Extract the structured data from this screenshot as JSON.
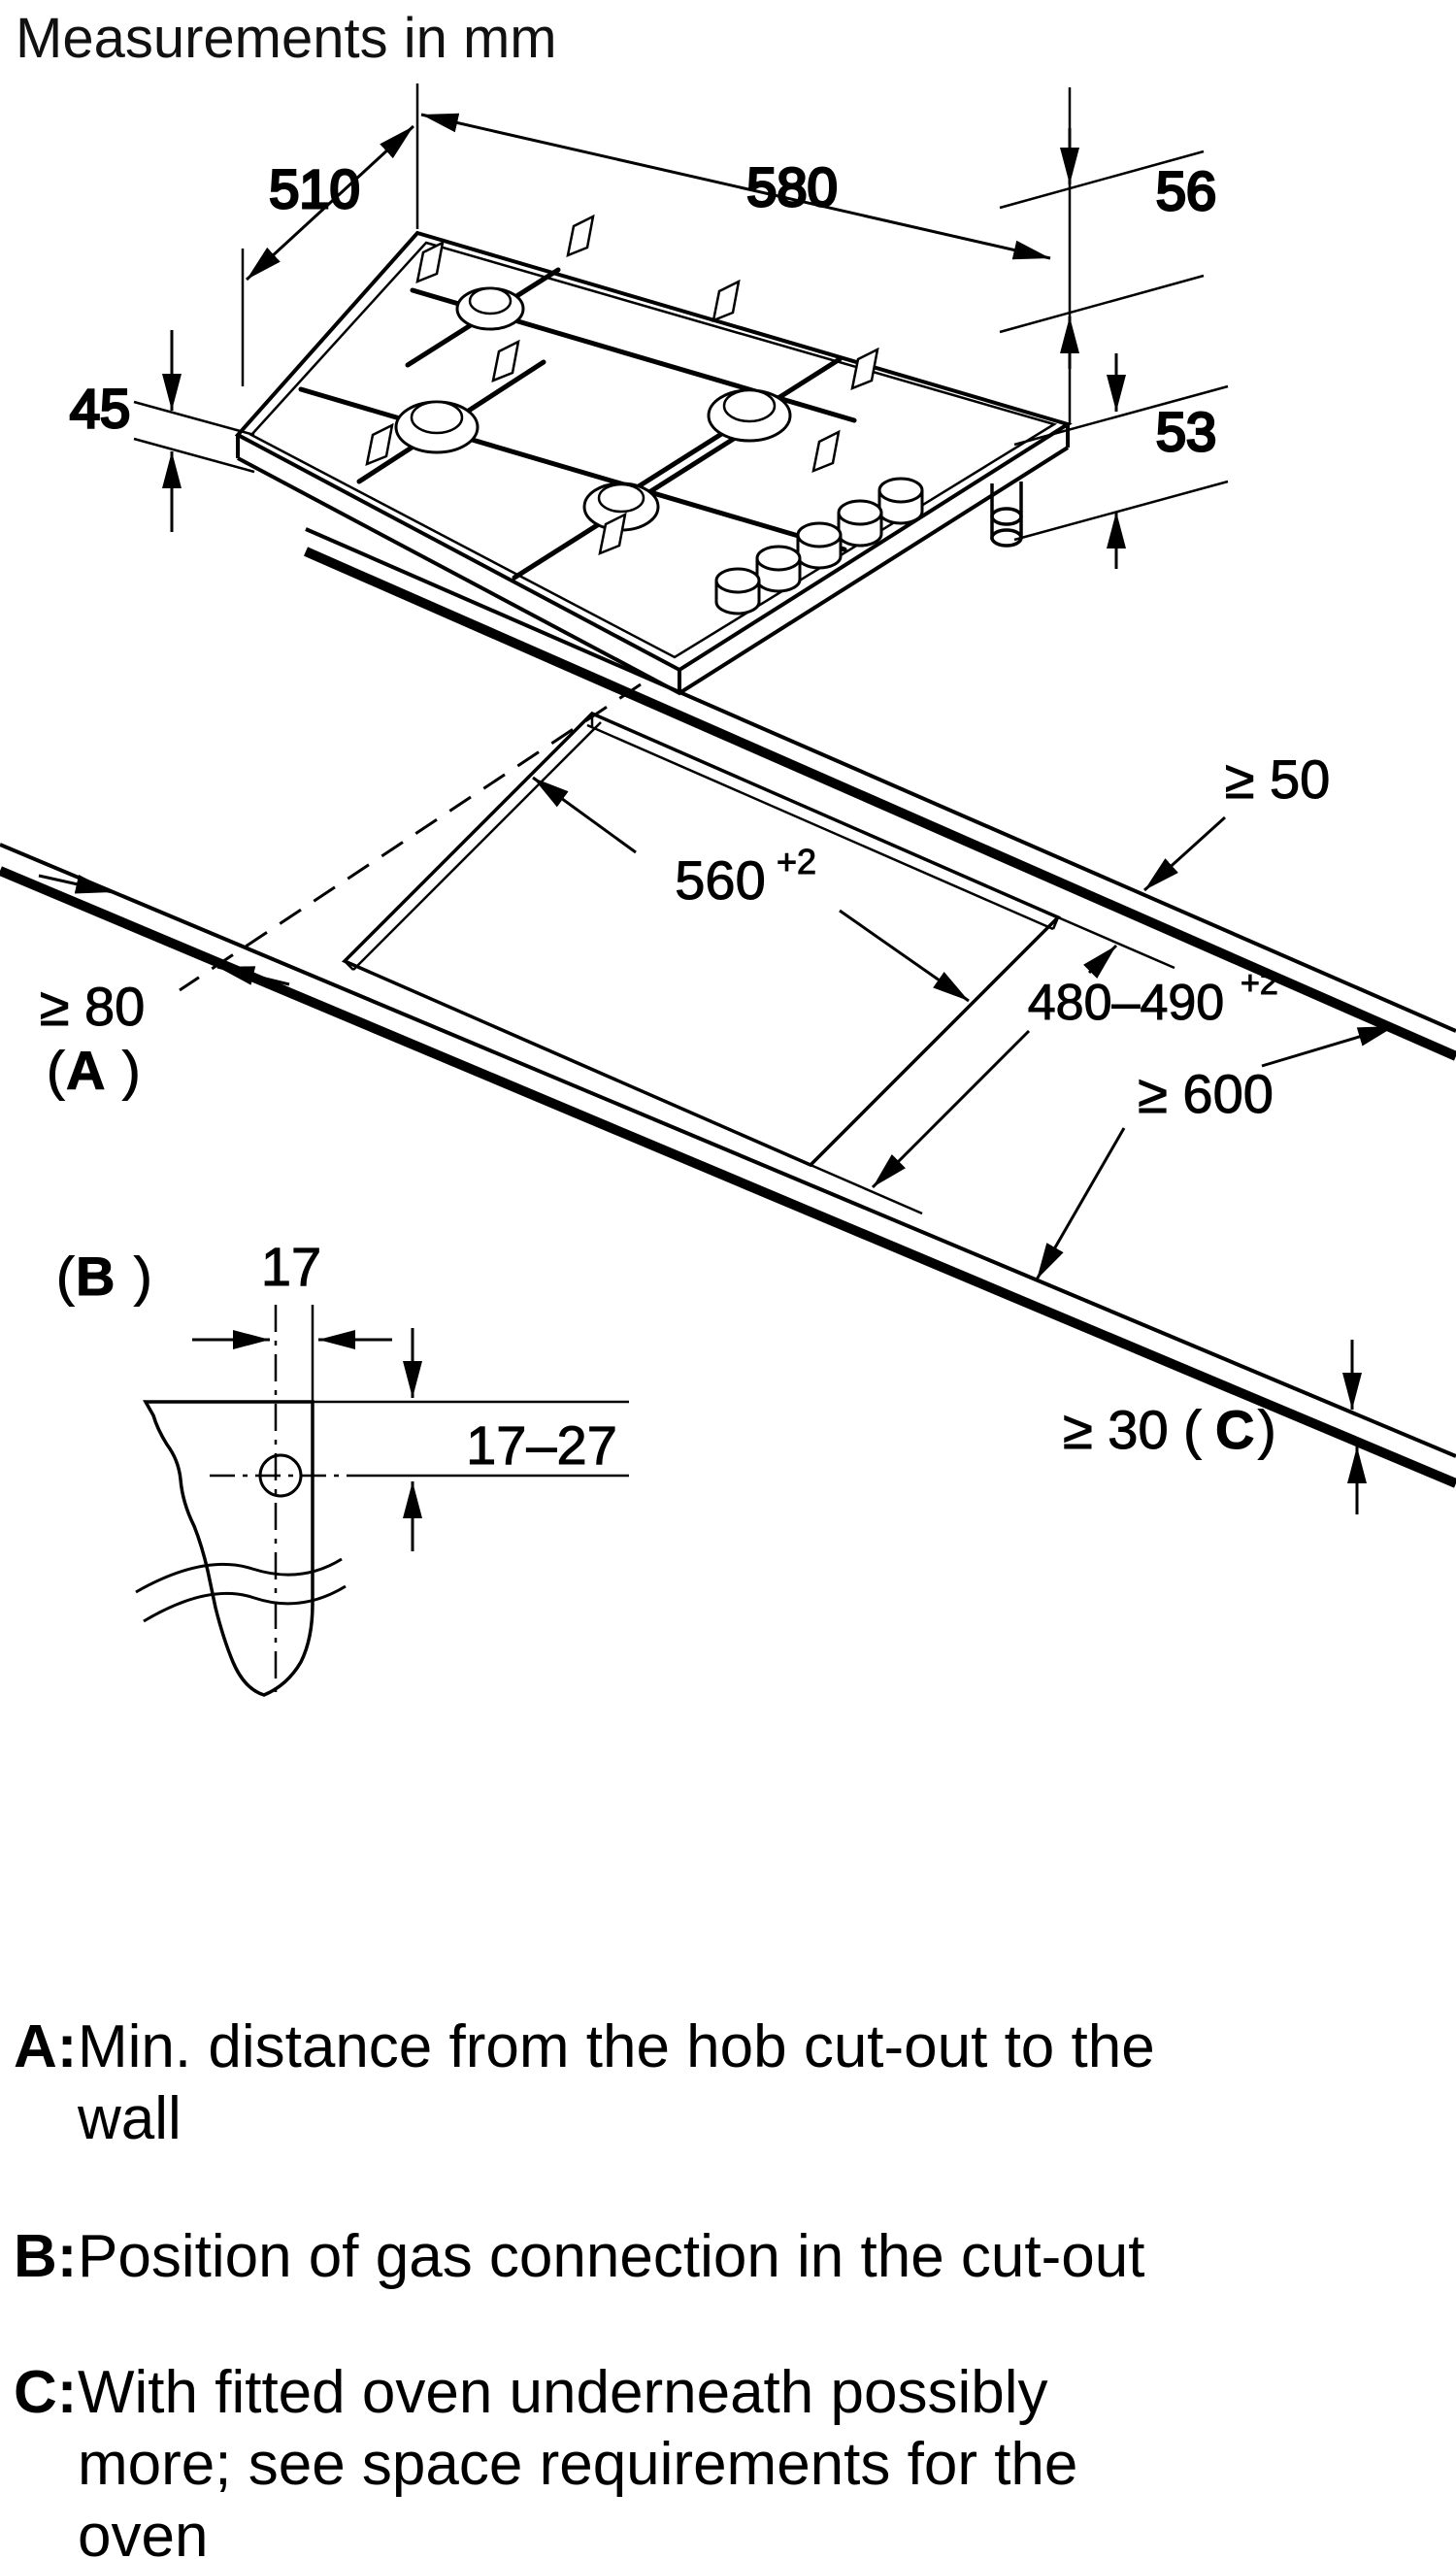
{
  "title": "Measurements in mm",
  "dims": {
    "hob_depth": "510",
    "hob_width": "580",
    "height_above": "56",
    "height_body": "53",
    "height_left": "45",
    "cutout_width": "560",
    "cutout_width_tol": "+2",
    "cutout_depth": "480–490",
    "cutout_depth_tol": "+2",
    "rear_clearance": "≥ 50",
    "side_clearance": "≥ 80",
    "worktop_depth": "≥ 600",
    "thickness_open": "≥ 30 (",
    "gas_offset_x": "17",
    "gas_offset_y": "17–27",
    "key_a": "A",
    "key_b": "B",
    "key_c": "C",
    "paren_open": "(",
    "paren_close": ")"
  },
  "legend": {
    "a_key": "A:",
    "a_line1": "Min. distance from the hob cut-out to the",
    "a_line2": "wall",
    "b_key": "B:",
    "b_line1": "Position of gas connection in the cut-out",
    "c_key": "C:",
    "c_line1": "With fitted oven underneath possibly",
    "c_line2": "more; see space requirements for the",
    "c_line3": "oven"
  }
}
